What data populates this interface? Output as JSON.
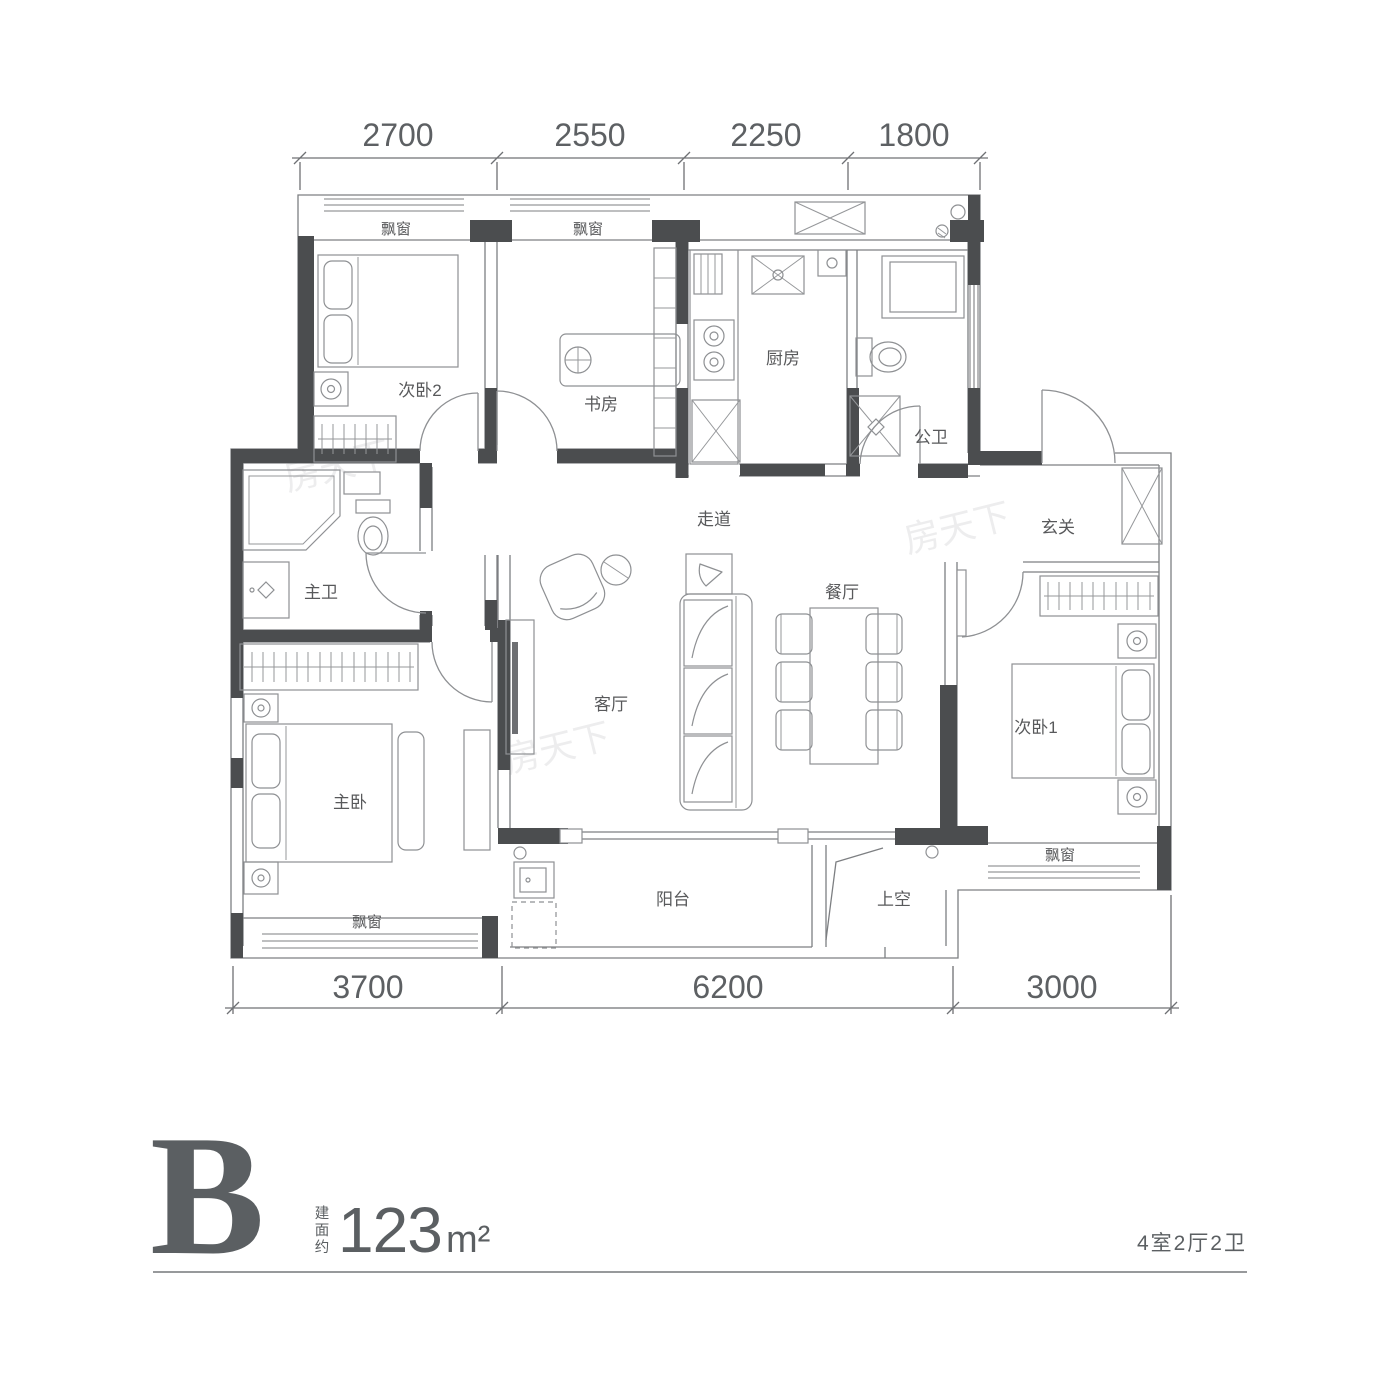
{
  "unit": {
    "name": "B",
    "area_prefix_chars": [
      "建",
      "面",
      "约"
    ],
    "area_value": "123",
    "area_unit": "m²",
    "layout_spec": "4室2厅2卫"
  },
  "dimensions": {
    "top": [
      "2700",
      "2550",
      "2250",
      "1800"
    ],
    "bottom": [
      "3700",
      "6200",
      "3000"
    ]
  },
  "rooms": [
    {
      "id": "bedroom2",
      "label": "次卧2"
    },
    {
      "id": "study",
      "label": "书房"
    },
    {
      "id": "kitchen",
      "label": "厨房"
    },
    {
      "id": "bath-public",
      "label": "公卫"
    },
    {
      "id": "corridor",
      "label": "走道"
    },
    {
      "id": "foyer",
      "label": "玄关"
    },
    {
      "id": "bath-master",
      "label": "主卫"
    },
    {
      "id": "living",
      "label": "客厅"
    },
    {
      "id": "dining",
      "label": "餐厅"
    },
    {
      "id": "bedroom-master",
      "label": "主卧"
    },
    {
      "id": "bedroom1",
      "label": "次卧1"
    },
    {
      "id": "balcony",
      "label": "阳台"
    },
    {
      "id": "void",
      "label": "上空"
    },
    {
      "id": "bay-bedroom2",
      "label": "飘窗"
    },
    {
      "id": "bay-study",
      "label": "飘窗"
    },
    {
      "id": "bay-master",
      "label": "飘窗"
    },
    {
      "id": "bay-bedroom1",
      "label": "飘窗"
    }
  ],
  "watermark": {
    "text": "房天下"
  },
  "colors": {
    "wall": "#4b4d4f",
    "line": "#7d7f82",
    "furniture_line": "#8e9093",
    "text": "#58595b",
    "footer_text": "#5b5f62"
  }
}
